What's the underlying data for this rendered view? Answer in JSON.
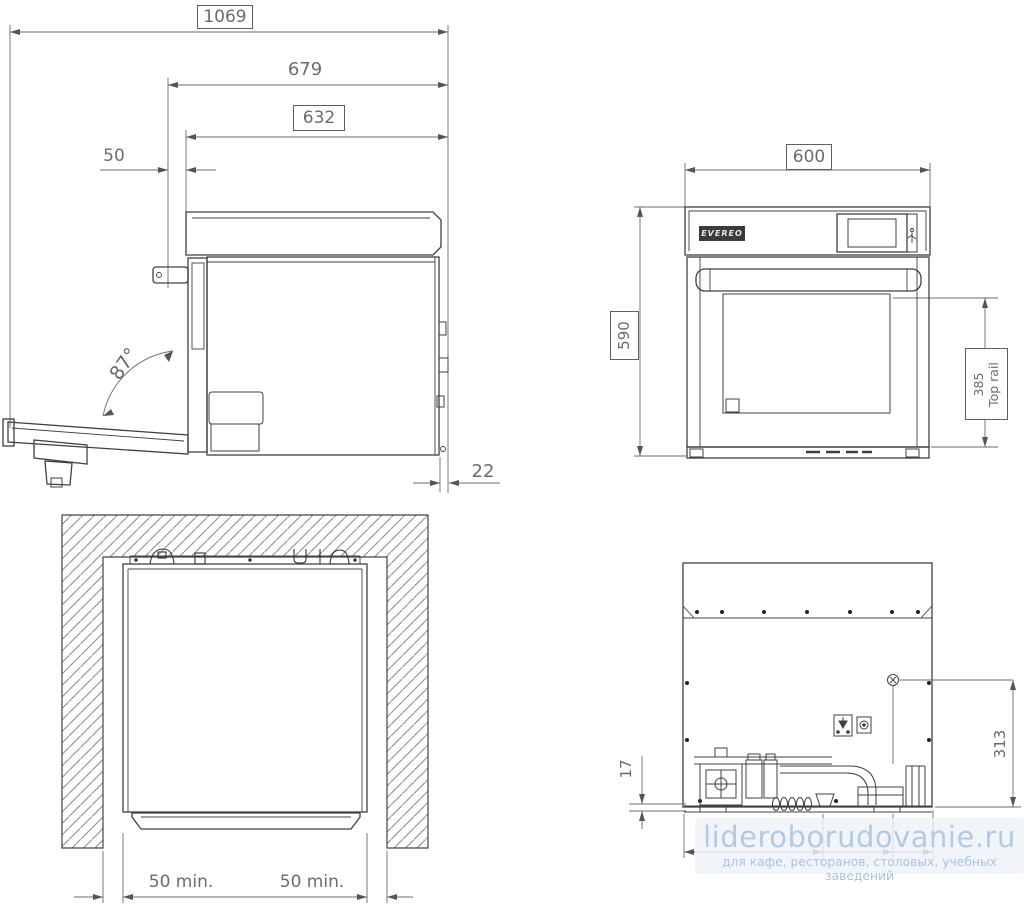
{
  "drawing_labels": {
    "side_view": {
      "overall_depth": "1069",
      "depth_open": "679",
      "body_depth": "632",
      "front_offset": "50",
      "door_angle": "87°",
      "rear_gap": "22"
    },
    "front_view": {
      "width": "600",
      "height": "590",
      "rail_value": "385",
      "rail_label": "Top rail",
      "brand": "EVEREO"
    },
    "niche_view": {
      "left_clearance": "50 min.",
      "right_clearance": "50 min."
    },
    "rear_view": {
      "bottom_gap": "17",
      "connector_height": "313"
    },
    "watermark": {
      "title": "lideroborudovanie.ru",
      "subtitle": "для кафе, ресторанов, столовых, учебных заведений"
    },
    "colors": {
      "object_line": "#404040",
      "dimension_line": "#6b6b6b",
      "watermark_text": "#b4cae1"
    }
  }
}
